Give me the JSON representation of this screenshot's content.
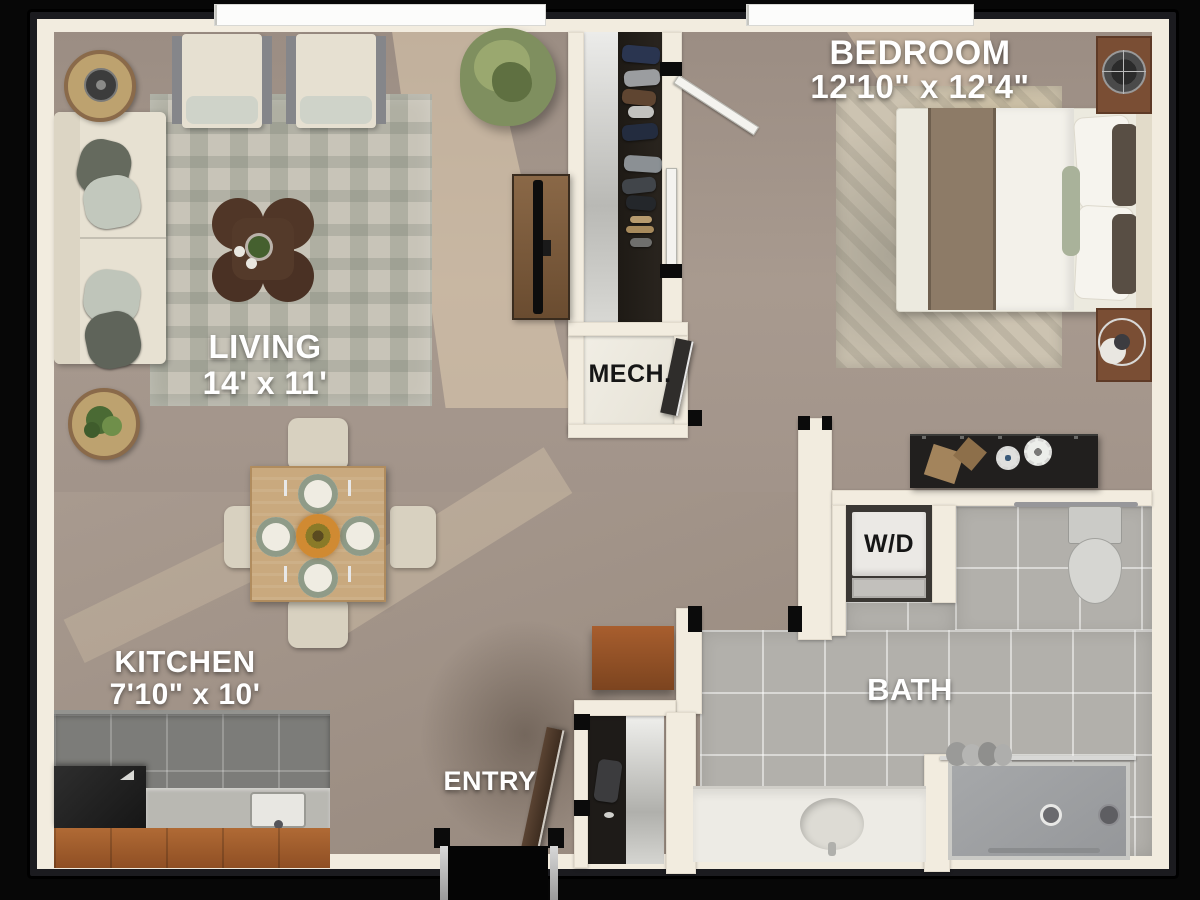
{
  "type": "apartment-floor-plan",
  "rooms": {
    "living": {
      "name": "LIVING",
      "dims": "14' x 11'"
    },
    "bedroom": {
      "name": "BEDROOM",
      "dims": "12'10\" x 12'4\""
    },
    "kitchen": {
      "name": "KITCHEN",
      "dims": "7'10\" x 10'"
    },
    "mech": {
      "name": "MECH."
    },
    "laundry": {
      "name": "W/D"
    },
    "bath": {
      "name": "BATH"
    },
    "entry": {
      "name": "ENTRY"
    }
  },
  "palette": {
    "background": "#070707",
    "wall": "#f2ecdf",
    "carpet": "#a3958b",
    "bath_tile": "#b2b0ab",
    "kitchen_tile": "#7c7c79",
    "cabinet_wood": "#a4602f",
    "bed_throw": "#8d7b67",
    "closet_floor": "#252119"
  }
}
